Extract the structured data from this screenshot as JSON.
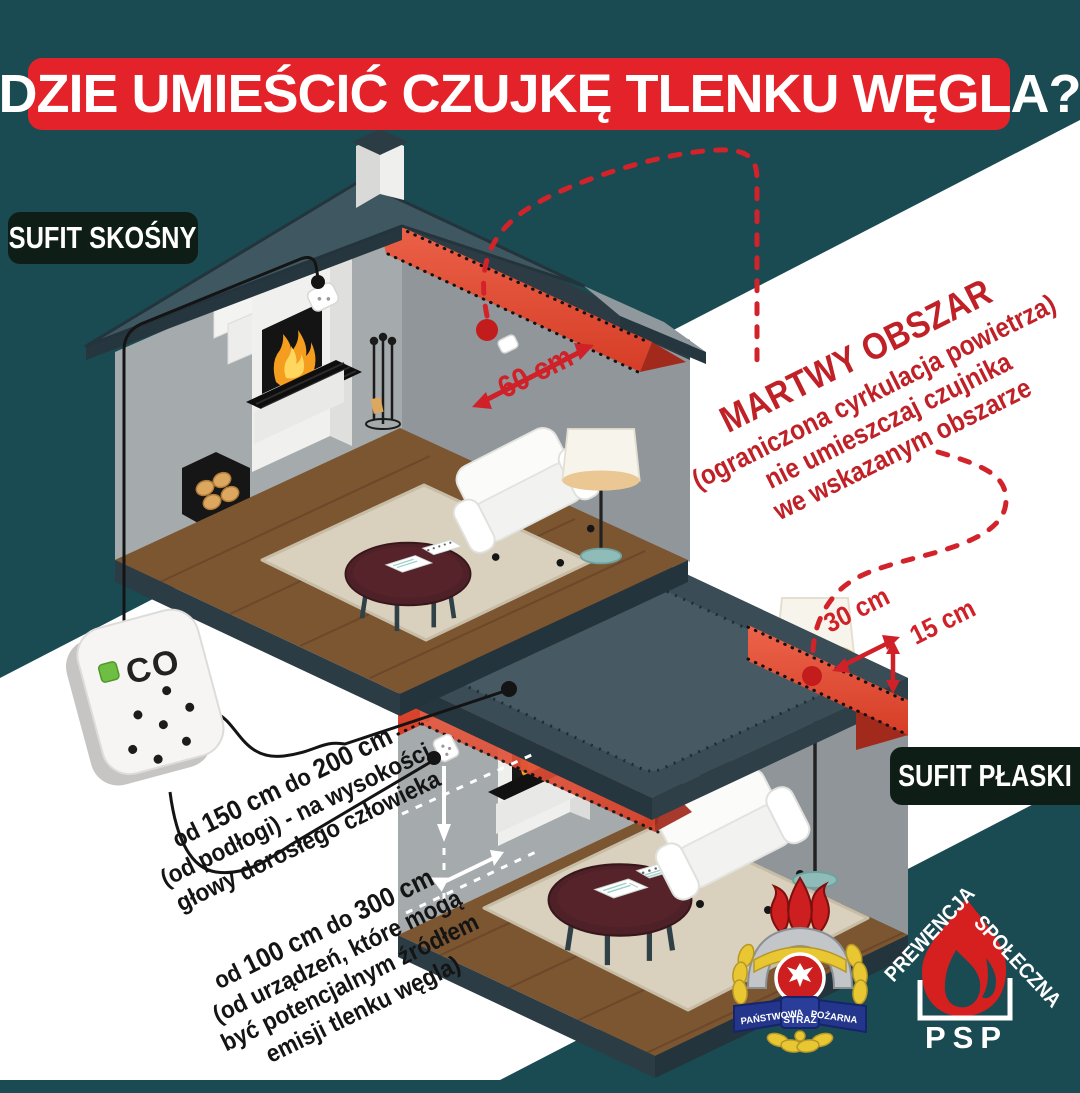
{
  "header": {
    "title": "GDZIE UMIEŚCIĆ CZUJKĘ TLENKU WĘGLA?"
  },
  "section_labels": {
    "sloped_ceiling": "SUFIT SKOŚNY",
    "flat_ceiling": "SUFIT PŁASKI"
  },
  "dead_zone_warning": {
    "title": "MARTWY OBSZAR",
    "line2": "(ograniczona cyrkulacja powietrza)",
    "line3": "nie umieszczaj czujnika",
    "line4": "we wskazanym obszarze"
  },
  "measurements": {
    "ridge_distance": "60 cm",
    "wall_distance": "30 cm",
    "ceiling_distance": "15 cm",
    "height_rule": {
      "pre": "od",
      "v1": "150 cm",
      "mid": "do",
      "v2": "200 cm",
      "line2": "(od podłogi) - na wysokości",
      "line3": "głowy dorosłego człowieka"
    },
    "source_rule": {
      "pre": "od",
      "v1": "100 cm",
      "mid": "do",
      "v2": "300 cm",
      "line2": "(od urządzeń, które mogą",
      "line3": "być potencjalnym źródłem",
      "line4": "emisji tlenku węgla)"
    }
  },
  "detector": {
    "label": "CO"
  },
  "logos": {
    "psp_badge": {
      "word1": "PAŃSTWOWA",
      "word2": "STRAŻ",
      "word3": "POŻARNA"
    },
    "psp_prevention": {
      "top_left": "PREWENCJA",
      "top_right": "SPOŁECZNA",
      "bottom": "PSP"
    }
  },
  "colors": {
    "background_teal": "#1a4a52",
    "banner_red": "#e42229",
    "dead_zone_red": "#e05036",
    "accent_red": "#cf2127",
    "chip_dark": "#0f1d17",
    "stripe_white": "#ffffff",
    "roof_slate": "#3f5761",
    "led_green": "#6fbe44"
  }
}
